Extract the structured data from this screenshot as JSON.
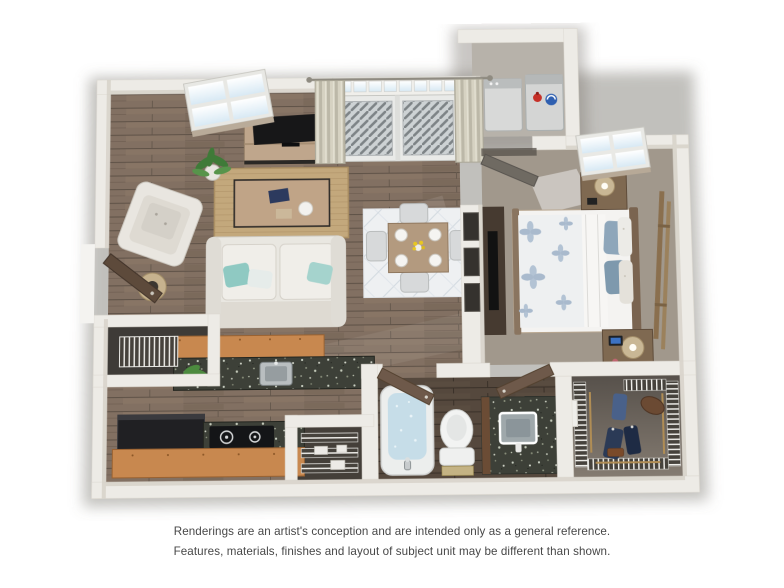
{
  "palette": {
    "bg": "#ffffff",
    "wall": "#edebe6",
    "wall_edge": "#d6d1c8",
    "wood_floor": "#7b6a5d",
    "wood_floor_dark": "#574b41",
    "bath_floor": "#55483d",
    "carpet": "#a89e92",
    "closet_floor_dark": "#57514b",
    "closet_floor_light": "#847b71",
    "cabinet": "#c8884f",
    "granite": "#3d4038",
    "rug_jute": "#c3a87c",
    "rug_white": "#eef0f2",
    "sofa": "#e9e7e1",
    "water": "#c6dde8",
    "accent_teal": "#8fc9c2",
    "appliance_dark": "#202023",
    "door_brown": "#6e594a",
    "door_gray": "#6f6a62",
    "detergent_red": "#c63028",
    "detergent_blue": "#2e5fb0",
    "text": "#474747"
  },
  "floorplan": {
    "view": "3D top-down rendering of a one-bedroom apartment",
    "rooms": [
      {
        "name": "living-room",
        "items": [
          "window",
          "tv-console",
          "tv",
          "potted-plant",
          "armchair",
          "floor-lamp",
          "sofa",
          "coffee-table",
          "jute-rug",
          "wall-art"
        ]
      },
      {
        "name": "dining-area",
        "items": [
          "dining-table",
          "four-chairs",
          "four-place-settings",
          "flower-centerpiece",
          "patterned-rug"
        ]
      },
      {
        "name": "balcony-entrance",
        "items": [
          "french-doors",
          "balcony-railing",
          "curtain-panels",
          "curtain-rod"
        ]
      },
      {
        "name": "laundry-closet",
        "items": [
          "washer",
          "dryer",
          "detergent-bottles",
          "louvered-door"
        ]
      },
      {
        "name": "bedroom",
        "items": [
          "window",
          "bed",
          "floral-duvet",
          "pillows",
          "nightstand-upper",
          "nightstand-lower",
          "table-lamps",
          "dresser-with-tv",
          "leaning-ladder-mirror",
          "carpet"
        ]
      },
      {
        "name": "kitchen",
        "items": [
          "breakfast-bar",
          "granite-counter",
          "sink",
          "herb-plant",
          "refrigerator",
          "cooktop",
          "cabinets"
        ]
      },
      {
        "name": "entry",
        "items": [
          "front-door",
          "coat-closet-wire-rack"
        ]
      },
      {
        "name": "pantry",
        "items": [
          "wire-shelves",
          "stored-boxes"
        ]
      },
      {
        "name": "bathroom",
        "items": [
          "bathtub",
          "faucet",
          "toilet",
          "bath-mat",
          "granite-vanity",
          "sink",
          "open-doors"
        ]
      },
      {
        "name": "walk-in-closet",
        "items": [
          "wire-shelving",
          "hanging-rods",
          "hanging-clothes",
          "duffel-bag"
        ]
      }
    ]
  },
  "disclaimer": {
    "line1": "Renderings are an artist's conception and are intended only as a general reference.",
    "line2": "Features, materials, finishes and layout of subject unit may be different than shown."
  }
}
